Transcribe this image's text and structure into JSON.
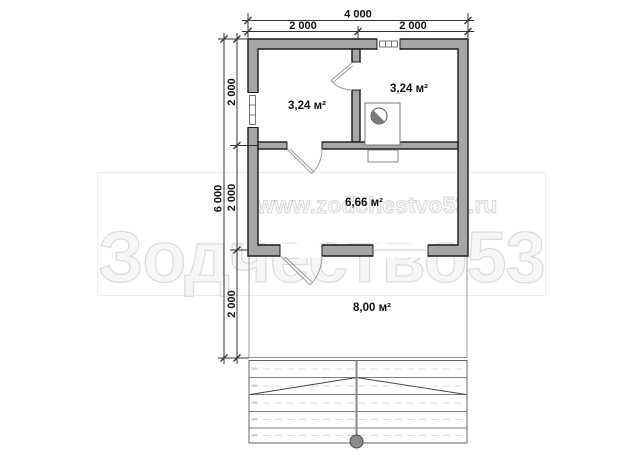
{
  "watermark": {
    "url": "www.zodchestvo53.ru",
    "brand": "Зодчество53"
  },
  "dimensions": {
    "top": {
      "total": "4 000",
      "left": "2 000",
      "right": "2 000"
    },
    "left": {
      "total": "6 000",
      "segments": [
        "2 000",
        "2 000",
        "2 000"
      ]
    }
  },
  "rooms": [
    {
      "name": "room-top-left",
      "area": "3,24 м²"
    },
    {
      "name": "room-top-right",
      "area": "3,24 м²"
    },
    {
      "name": "room-main",
      "area": "6,66 м²"
    },
    {
      "name": "terrace",
      "area": "8,00 м²"
    }
  ],
  "colors": {
    "wall_fill": "#a6a6a6",
    "wall_stroke": "#1a1a1a",
    "dim_color": "#222222",
    "thin_line": "#999999",
    "stove_accent": "#7a7a7a"
  }
}
